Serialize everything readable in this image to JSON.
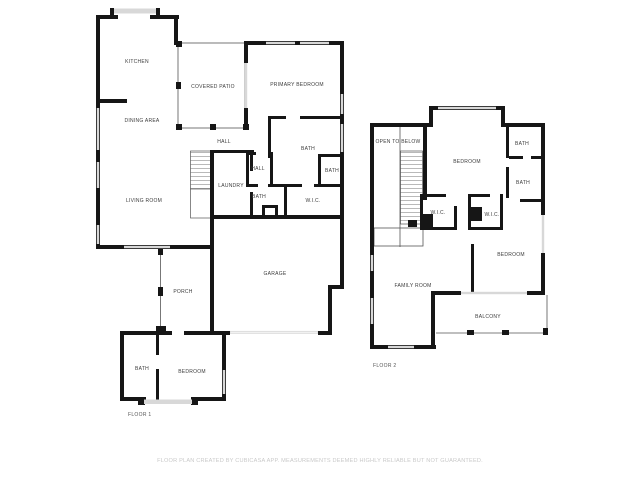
{
  "floor1": {
    "name": "FLOOR 1",
    "rooms": {
      "kitchen": "KITCHEN",
      "dining_area": "DINING AREA",
      "living_room": "LIVING ROOM",
      "covered_patio": "COVERED PATIO",
      "primary_bedroom": "PRIMARY BEDROOM",
      "hall_upper": "HALL",
      "hall_inner": "HALL",
      "bath_primary": "BATH",
      "bath_small": "BATH",
      "bath_hall": "BATH",
      "wic": "W.I.C.",
      "laundry": "LAUNDRY",
      "porch": "PORCH",
      "garage": "GARAGE",
      "bath_guest": "BATH",
      "bedroom_guest": "BEDROOM"
    }
  },
  "floor2": {
    "name": "FLOOR 2",
    "rooms": {
      "open_to_below": "OPEN TO BELOW",
      "bedroom_top": "BEDROOM",
      "bath_top": "BATH",
      "bath_mid": "BATH",
      "wic_left": "W.I.C.",
      "wic_right": "W.I.C.",
      "family_room": "FAMILY ROOM",
      "bedroom_right": "BEDROOM",
      "balcony": "BALCONY"
    }
  },
  "footer": {
    "disclaimer": "FLOOR PLAN CREATED BY CUBICASA APP. MEASUREMENTS DEEMED HIGHLY RELIABLE BUT NOT GUARANTEED."
  },
  "colors": {
    "wall": "#161616",
    "window": "#d8d8d8",
    "thin_line": "#555555",
    "garage_door": "#f1f1f1",
    "label": "#3c3c3c",
    "footer_text": "#c9c9c9",
    "background": "#ffffff"
  }
}
